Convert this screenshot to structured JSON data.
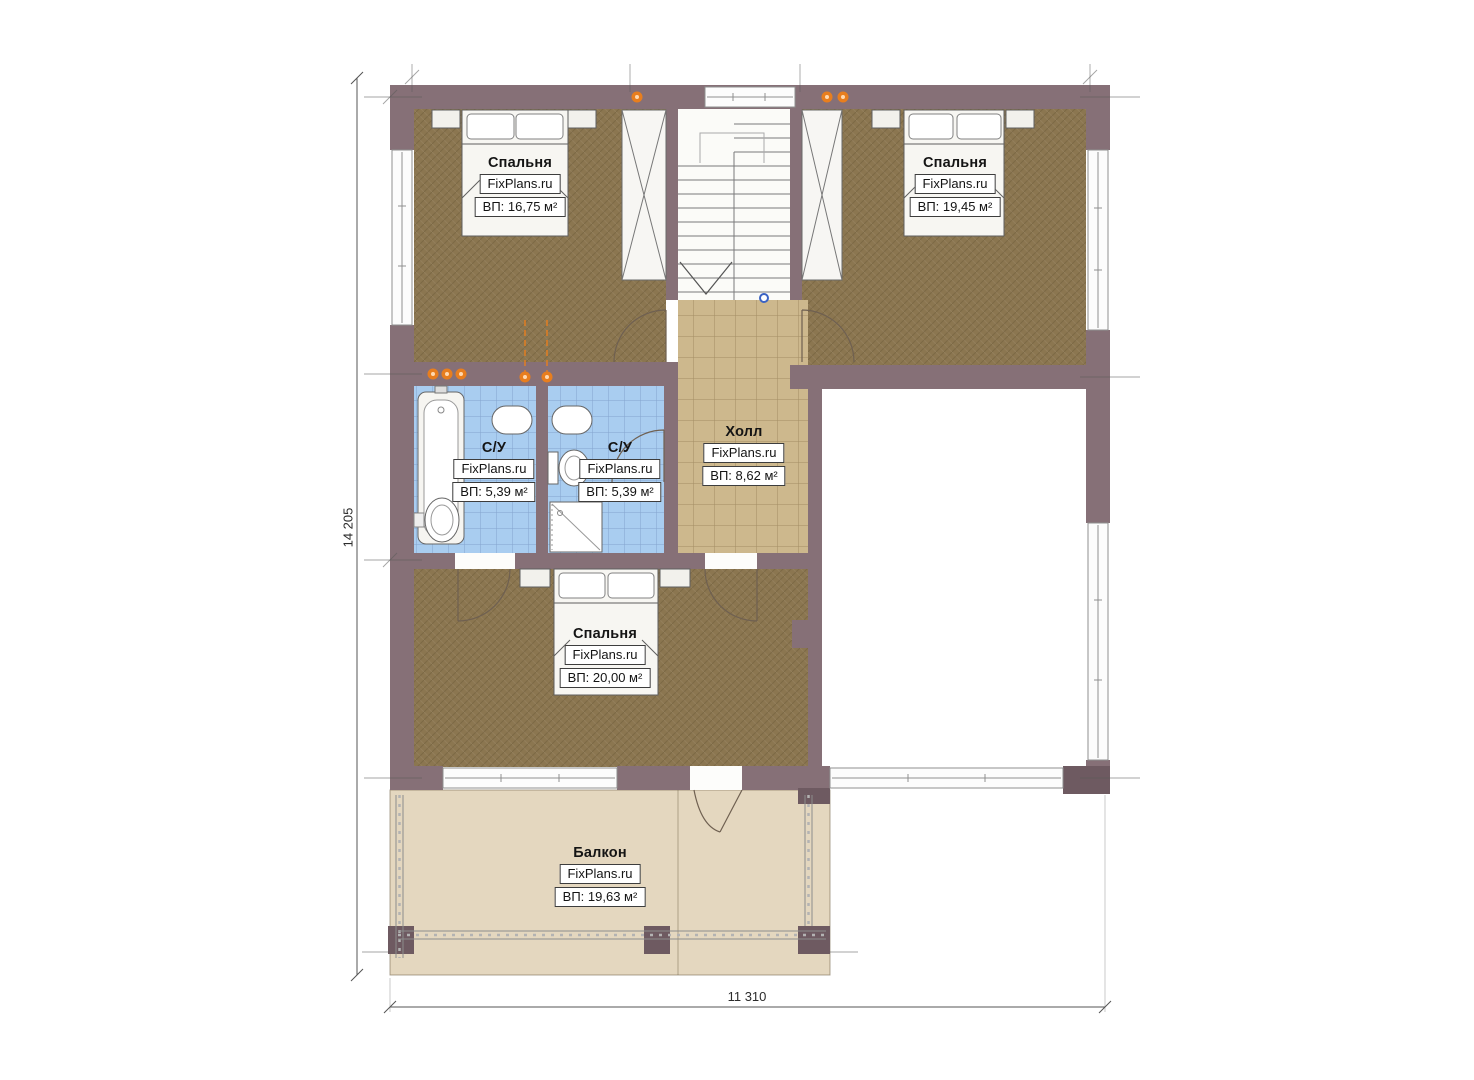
{
  "plan": {
    "title": "second-floor-plan",
    "dimensions": {
      "vertical_total": "14 205",
      "horizontal_total": "11 310"
    },
    "rooms": [
      {
        "id": "bedroom-top-left",
        "name": "Спальня",
        "brand": "FixPlans.ru",
        "area": "ВП: 16,75 м²"
      },
      {
        "id": "bedroom-top-right",
        "name": "Спальня",
        "brand": "FixPlans.ru",
        "area": "ВП: 19,45 м²"
      },
      {
        "id": "bathroom-left",
        "name": "С/У",
        "brand": "FixPlans.ru",
        "area": "ВП: 5,39 м²"
      },
      {
        "id": "bathroom-right",
        "name": "С/У",
        "brand": "FixPlans.ru",
        "area": "ВП: 5,39 м²"
      },
      {
        "id": "hall",
        "name": "Холл",
        "brand": "FixPlans.ru",
        "area": "ВП: 8,62 м²"
      },
      {
        "id": "bedroom-bottom",
        "name": "Спальня",
        "brand": "FixPlans.ru",
        "area": "ВП: 20,00 м²"
      },
      {
        "id": "balcony",
        "name": "Балкон",
        "brand": "FixPlans.ru",
        "area": "ВП: 19,63 м²"
      }
    ],
    "colors": {
      "wall": "#867077",
      "wall_dark_post": "#6e5a61",
      "bedroom_floor": "#8b7650",
      "hall_tile_floor": "#cdb88d",
      "bathroom_tile_floor": "#a9cdf0",
      "balcony_floor": "#e4d7bf",
      "accent_orange_light": "#e87e1e",
      "stair_start_marker_blue": "#3b63c4"
    }
  }
}
